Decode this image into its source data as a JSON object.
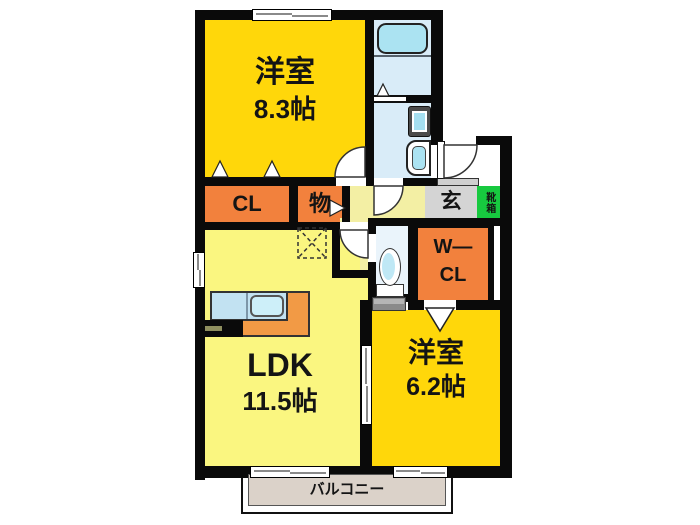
{
  "title": "2LDK apartment floor plan",
  "rooms": {
    "bedroom83": {
      "name": "洋室",
      "size": "8.3帖"
    },
    "ldk": {
      "name": "LDK",
      "size": "11.5帖"
    },
    "bedroom62": {
      "name": "洋室",
      "size": "6.2帖"
    },
    "closet": {
      "label": "CL"
    },
    "storage": {
      "label": "物"
    },
    "genkan": {
      "label": "玄"
    },
    "shoebox": {
      "label": "靴箱"
    },
    "walkin_closet": {
      "line1": "W—",
      "line2": "CL"
    },
    "balcony": {
      "label": "バルコニー"
    }
  },
  "fixtures": {
    "bathtub": "bathtub",
    "washbasin": "washbasin",
    "washing_machine": "washing-machine-pan",
    "toilet": "toilet",
    "kitchen_sink": "kitchen-sink",
    "stove": "stove",
    "refrigerator_space": "refrigerator-space"
  },
  "colors": {
    "room_gold": "#FFD70A",
    "ldk_pale_yellow": "#FAF680",
    "hall_yellow": "#F3EFA4",
    "closet_orange": "#F2813D",
    "kitchen_orange": "#F29A45",
    "genkan_gray": "#D4D4D4",
    "shoebox_green": "#17C93F",
    "wet_room_blue": "#D9ECF8",
    "fixture_cyan": "#ABE3F2",
    "balcony_beige": "#DBD2C9",
    "wall_black": "#0A0A0A"
  }
}
